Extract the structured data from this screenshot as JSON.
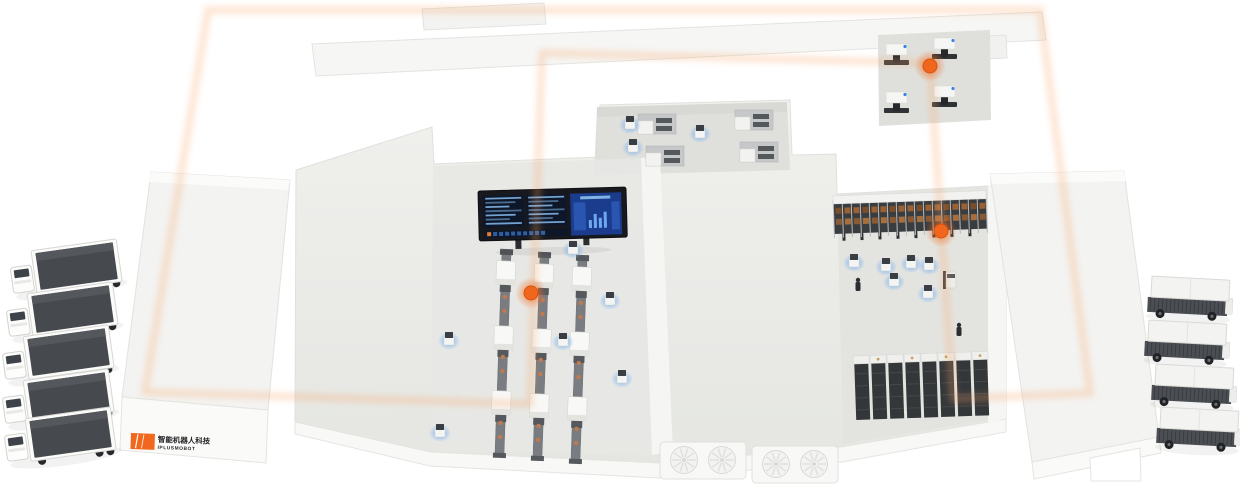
{
  "scene": {
    "description": "Isometric smart-factory facility with AGV routing loop",
    "background": "#FFFFFF"
  },
  "branding": {
    "logo_text_cn": "智能机器人科技",
    "logo_text_en": "IPLUSMOBOT",
    "logo_accent": "#F2671E",
    "logo_text_color": "#1F2123"
  },
  "palette": {
    "route_orange": "#F2671E",
    "route_glow": "#F8A468",
    "node_orange": "#F0661C",
    "robot_glow_blue": "#5FA4F6",
    "floor": "#ECEDEA",
    "floor_recess": "#DFE0DC",
    "wall_white": "#F6F6F4",
    "equipment_dark": "#3E4144",
    "screen_navy": "#0D1729",
    "screen_blue": "#1B3C8C",
    "screen_rows": "#7FB3E3",
    "box_brown": "#9A6234"
  },
  "route": {
    "style": "dashed",
    "dash": [
      6,
      4.5
    ],
    "loop": [
      [
        208,
        10
      ],
      [
        1040,
        10
      ],
      [
        1090,
        393
      ],
      [
        953,
        399
      ],
      [
        930,
        63
      ],
      [
        542,
        53
      ],
      [
        530,
        404
      ],
      [
        145,
        392
      ]
    ],
    "nodes": [
      [
        531,
        293
      ],
      [
        930,
        66
      ],
      [
        941,
        231
      ]
    ]
  },
  "equipment": {
    "dashboard_screen": {
      "x": 478,
      "y": 191,
      "rows_per_panel": 7,
      "panels": 2
    },
    "production_lines": {
      "tops": [
        [
          506,
          253
        ],
        [
          544,
          256
        ],
        [
          582,
          259
        ]
      ],
      "modules_per_line": 3
    },
    "machine_room_units": [
      [
        884,
        44
      ],
      [
        932,
        38
      ],
      [
        884,
        92
      ],
      [
        932,
        86
      ]
    ],
    "cabinet_room_units": [
      [
        638,
        114
      ],
      [
        735,
        110
      ],
      [
        646,
        146
      ],
      [
        740,
        142
      ]
    ],
    "rack_top_row": {
      "x": 833,
      "y": 196,
      "width": 153,
      "posts": 17
    },
    "rack_bottom_row": {
      "x": 854,
      "y": 356,
      "columns": 8
    },
    "hvac_units": [
      [
        660,
        442
      ],
      [
        752,
        446
      ]
    ]
  },
  "fleet": {
    "trucks_left": [
      [
        8,
        252
      ],
      [
        4,
        295
      ],
      [
        0,
        338
      ],
      [
        0,
        382
      ],
      [
        2,
        420
      ]
    ],
    "cargo_vehicles_right": [
      [
        1150,
        276
      ],
      [
        1147,
        320
      ],
      [
        1154,
        364
      ],
      [
        1159,
        407
      ]
    ],
    "mobile_robots": [
      [
        573,
        249
      ],
      [
        610,
        300
      ],
      [
        563,
        341
      ],
      [
        449,
        340
      ],
      [
        622,
        378
      ],
      [
        440,
        432
      ],
      [
        630,
        124
      ],
      [
        633,
        147
      ],
      [
        700,
        133
      ],
      [
        854,
        262
      ],
      [
        886,
        266
      ],
      [
        911,
        263
      ],
      [
        929,
        265
      ],
      [
        894,
        281
      ],
      [
        928,
        293
      ]
    ],
    "workers": [
      [
        858,
        286
      ],
      [
        959,
        331
      ]
    ],
    "forklift": [
      950,
      280
    ]
  }
}
